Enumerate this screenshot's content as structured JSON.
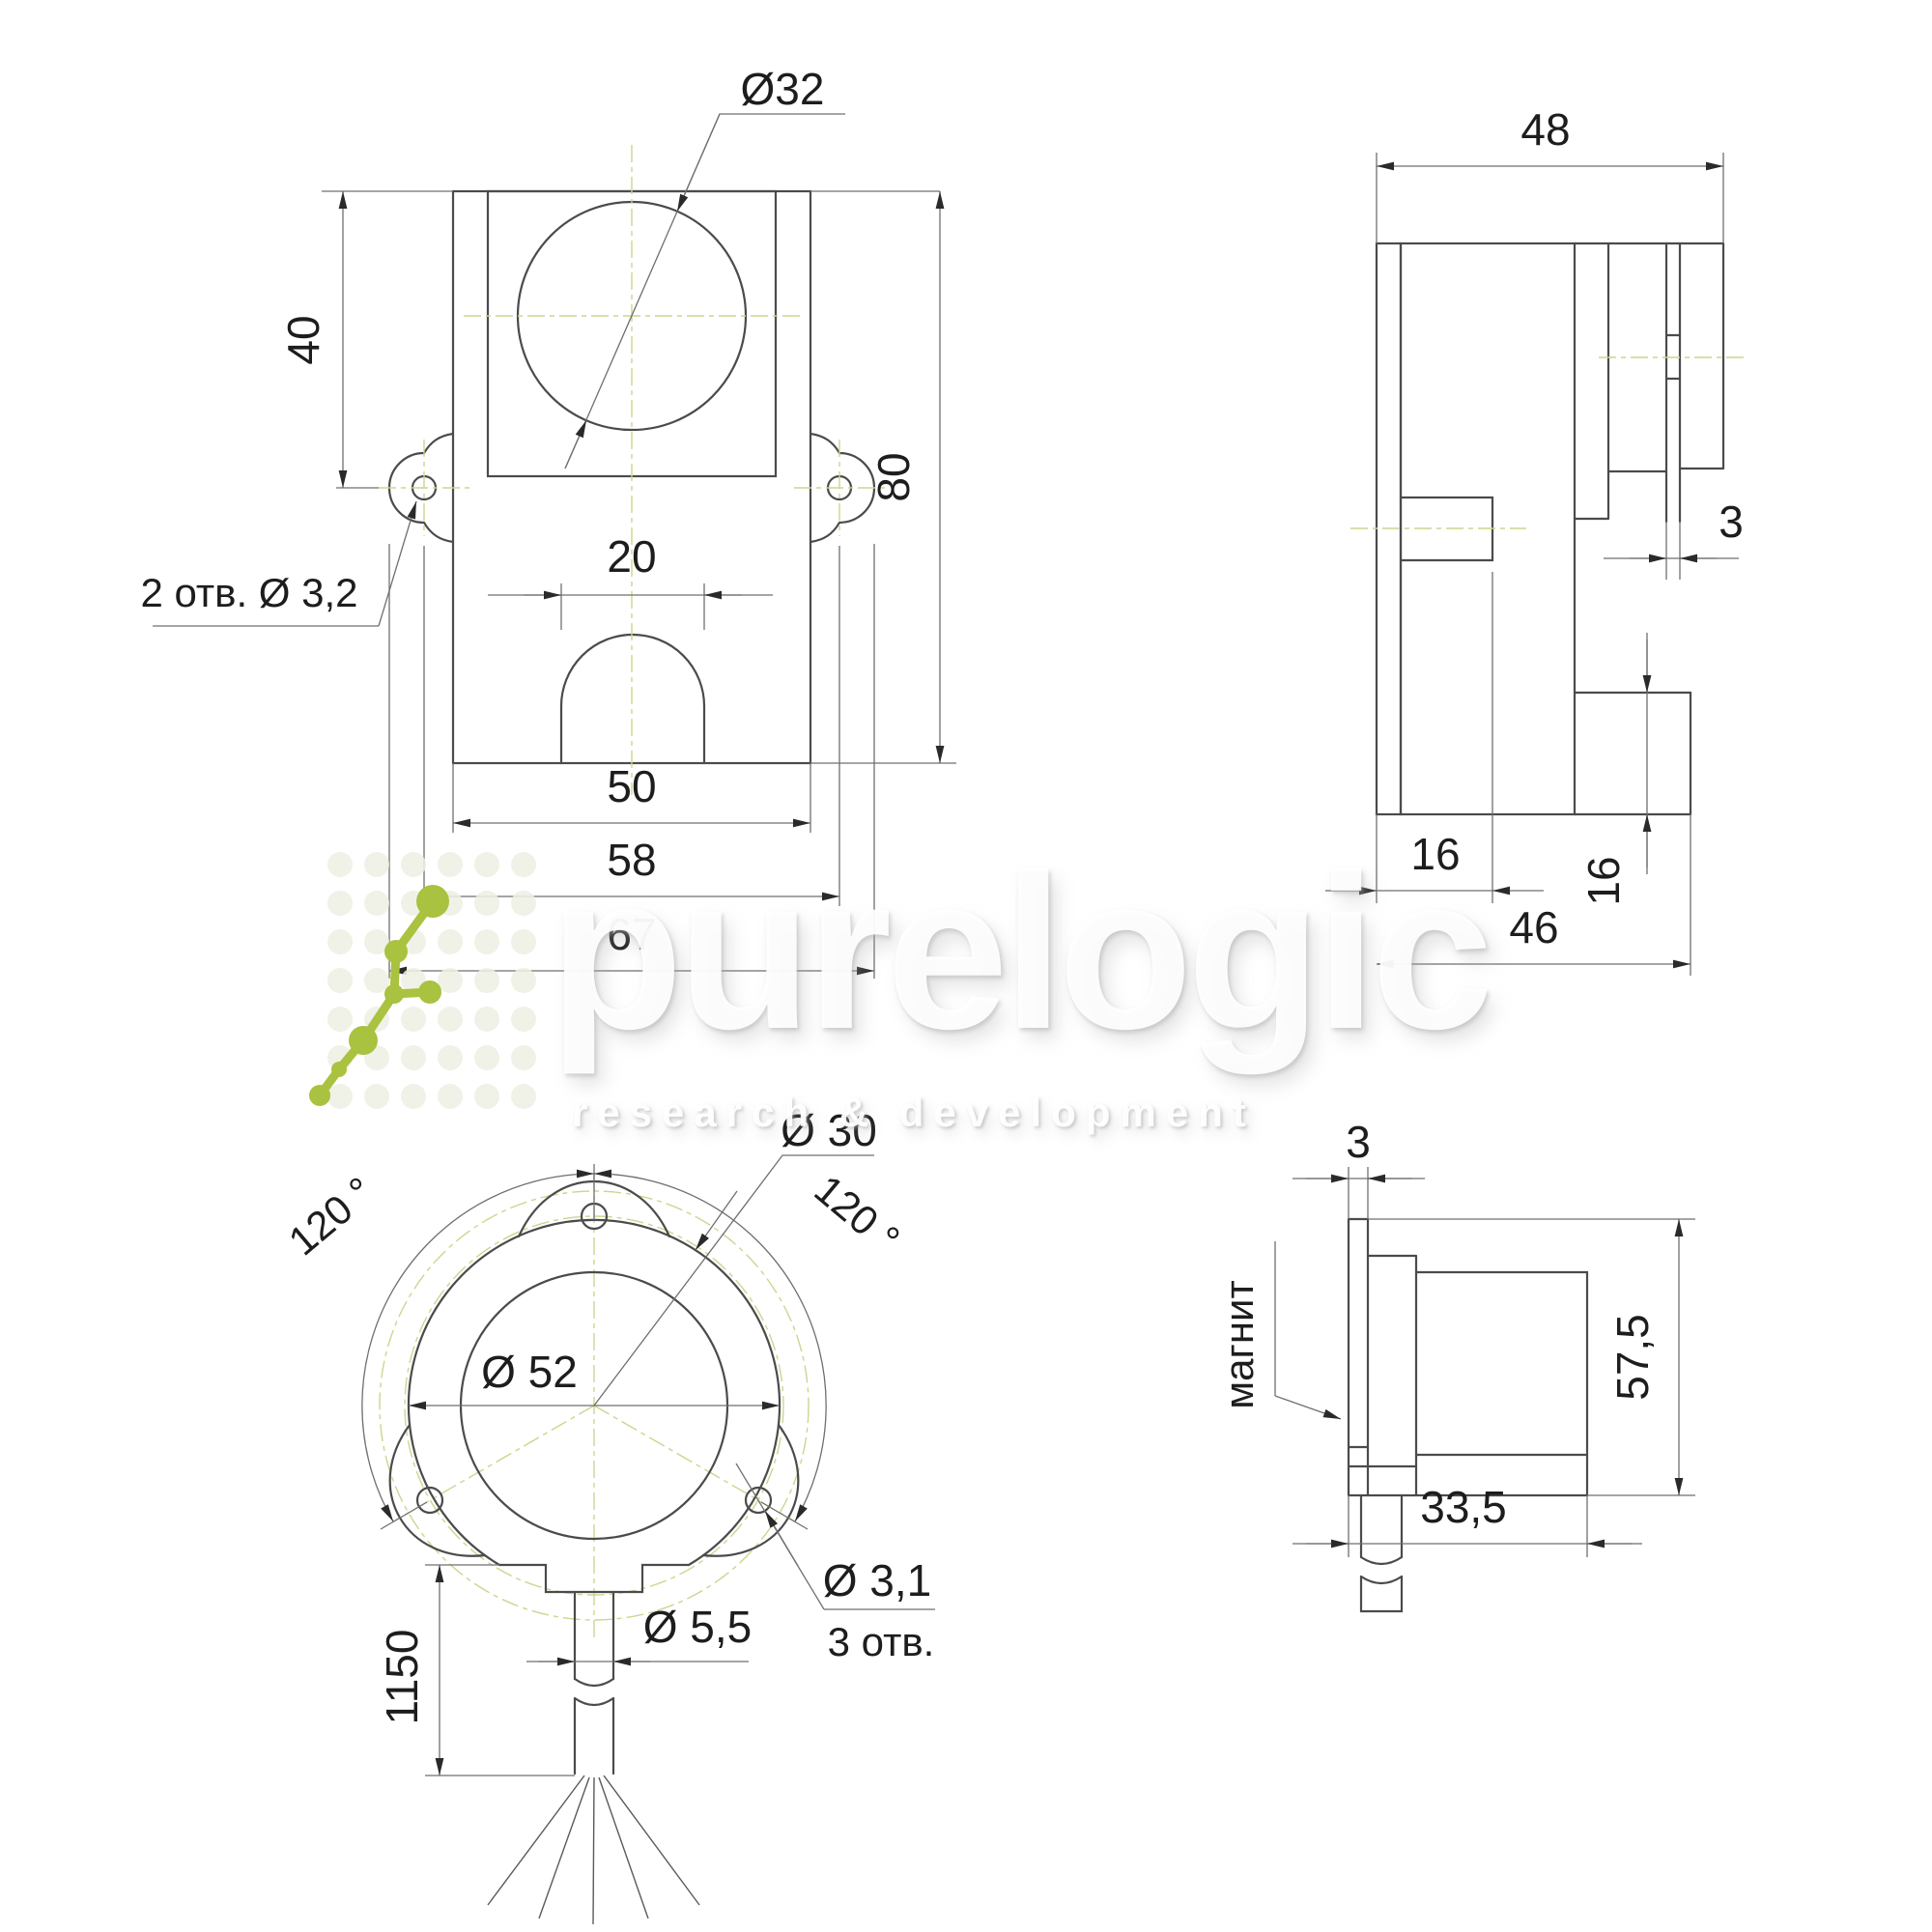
{
  "meta": {
    "type": "technical-drawing",
    "language": "ru"
  },
  "colors": {
    "line": "#4b4b4b",
    "dim_line": "#6f6f6f",
    "centerline_green": "#ccd68f",
    "accent_green": "#a9c23f",
    "text": "#1d1d1d"
  },
  "watermark": {
    "brand": "purelogic",
    "tagline": "research & development"
  },
  "front_view": {
    "dia32": "Ø32",
    "h40": "40",
    "h80": "80",
    "w20": "20",
    "w50": "50",
    "w58": "58",
    "w67": "67",
    "holes_note": "2 отв.  Ø 3,2"
  },
  "side_view": {
    "w48": "48",
    "gap3": "3",
    "h16": "16",
    "w16": "16",
    "w46": "46"
  },
  "ring_view": {
    "dia30": "Ø 30",
    "dia52": "Ø 52",
    "angle_left": "120 °",
    "angle_right": "120 °",
    "dia31": "Ø 3,1",
    "holes_note": "3 отв.",
    "dia55": "Ø 5,5",
    "cable_len": "1150"
  },
  "magnet_view": {
    "gap3": "3",
    "h575": "57,5",
    "w335": "33,5",
    "magnet_label": "магнит"
  }
}
